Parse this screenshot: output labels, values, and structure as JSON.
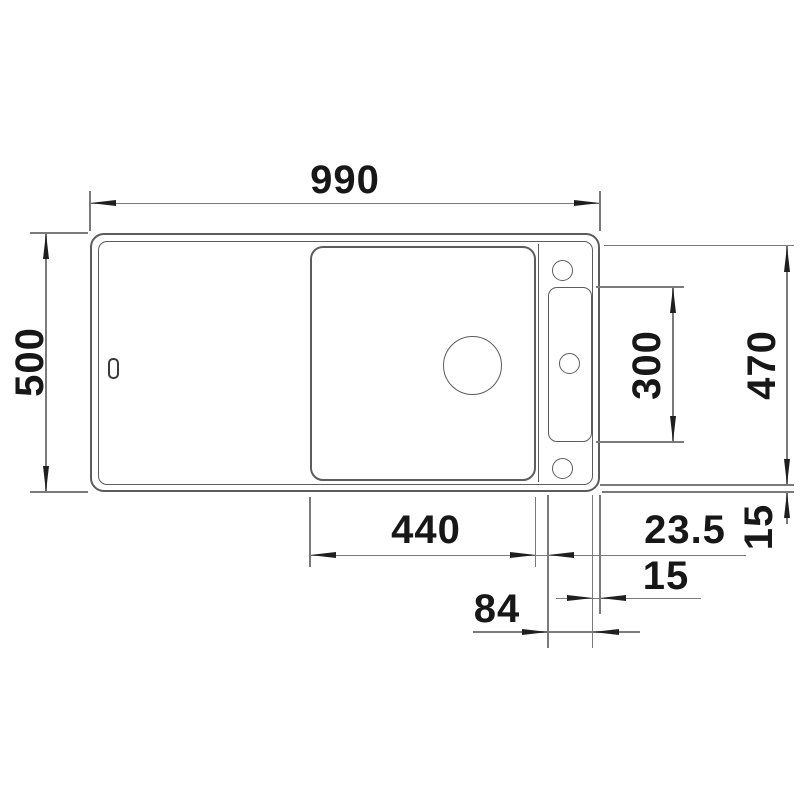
{
  "drawing": {
    "type": "technical dimension drawing - kitchen sink top view",
    "units": "mm",
    "labels": {
      "overall_width": "990",
      "overall_depth": "500",
      "inner_depth": "470",
      "tap_slot_length": "300",
      "bowl_width": "440",
      "bowl_to_slot_gap": "23.5",
      "rim_right_width": "15",
      "rim_bottom_width": "15",
      "tap_slot_width": "84"
    },
    "colors": {
      "background": "#ffffff",
      "outline": "#5c5c5c",
      "dimension_line": "#7a7a7a",
      "arrow": "#1f1f1f",
      "text": "#171717"
    }
  }
}
